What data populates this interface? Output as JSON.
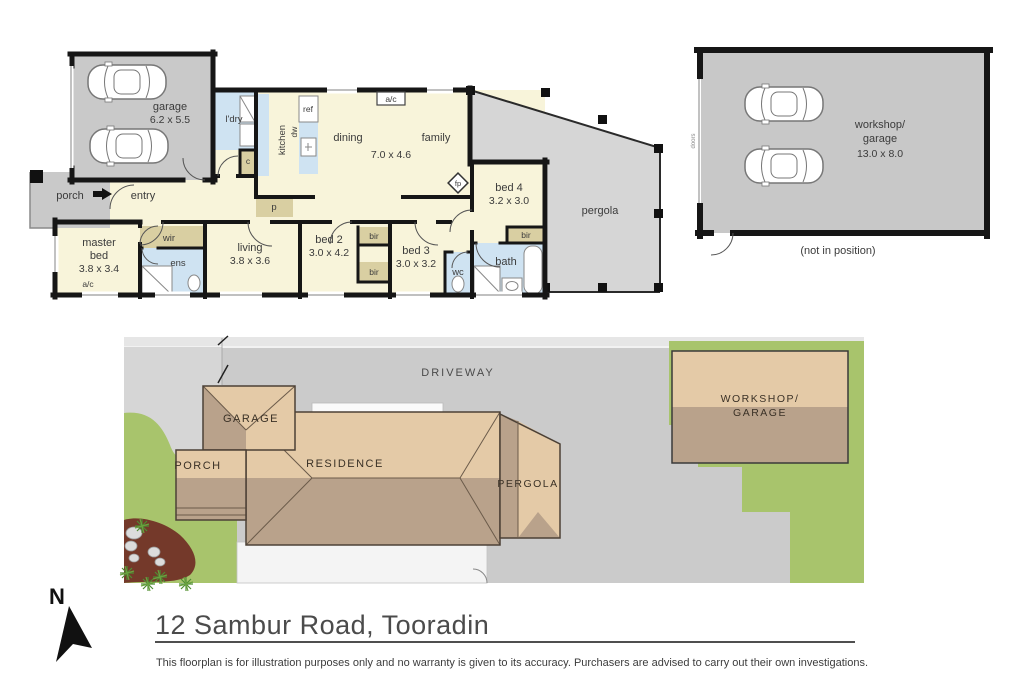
{
  "colors": {
    "wall": "#161616",
    "room_cream": "#f8f4da",
    "wet_blue": "#cfe3f2",
    "robe_tan": "#d9cfa2",
    "garage_gray": "#c9c9c9",
    "pergola_gray": "#d6d6d6",
    "driveway_gray": "#cbcbcb",
    "grass_green": "#a8c46c",
    "roof_light": "#e4caa7",
    "roof_dark": "#b9a28b",
    "mulch_brown": "#74392a",
    "concrete_white": "#f4f4f4"
  },
  "floorplan": {
    "garage": "garage",
    "garage_dims": "6.2 x 5.5",
    "porch": "porch",
    "entry": "entry",
    "laundry": "l'dry",
    "cupboard": "c",
    "kitchen": "kitchen",
    "dishwasher": "dw",
    "fridge": "ref",
    "pantry": "p",
    "dining": "dining",
    "family": "family",
    "family_dims": "7.0 x 4.6",
    "ac": "a/c",
    "fireplace": "fp",
    "bed4": "bed 4",
    "bed4_dims": "3.2 x 3.0",
    "bir": "bir",
    "master_line1": "master",
    "master_line2": "bed",
    "master_dims": "3.8 x 3.4",
    "wir": "wir",
    "ens": "ens",
    "living": "living",
    "living_dims": "3.8 x 3.6",
    "bed2": "bed 2",
    "bed2_dims": "3.0 x 4.2",
    "bed3": "bed 3",
    "bed3_dims": "3.0 x 3.2",
    "wc": "wc",
    "bath": "bath",
    "pergola": "pergola",
    "workshop_line1": "workshop/",
    "workshop_line2": "garage",
    "workshop_dims": "13.0 x 8.0",
    "workshop_note": "(not in position)",
    "doors": "doors"
  },
  "siteplan": {
    "driveway": "DRIVEWAY",
    "garage": "GARAGE",
    "porch": "PORCH",
    "residence": "RESIDENCE",
    "pergola": "PERGOLA",
    "workshop_line1": "WORKSHOP/",
    "workshop_line2": "GARAGE"
  },
  "footer": {
    "north": "N",
    "title": "12 Sambur Road, Tooradin",
    "disclaimer": "This floorplan is for illustration purposes only and no warranty is given to its accuracy. Purchasers are advised to carry out their own investigations."
  }
}
